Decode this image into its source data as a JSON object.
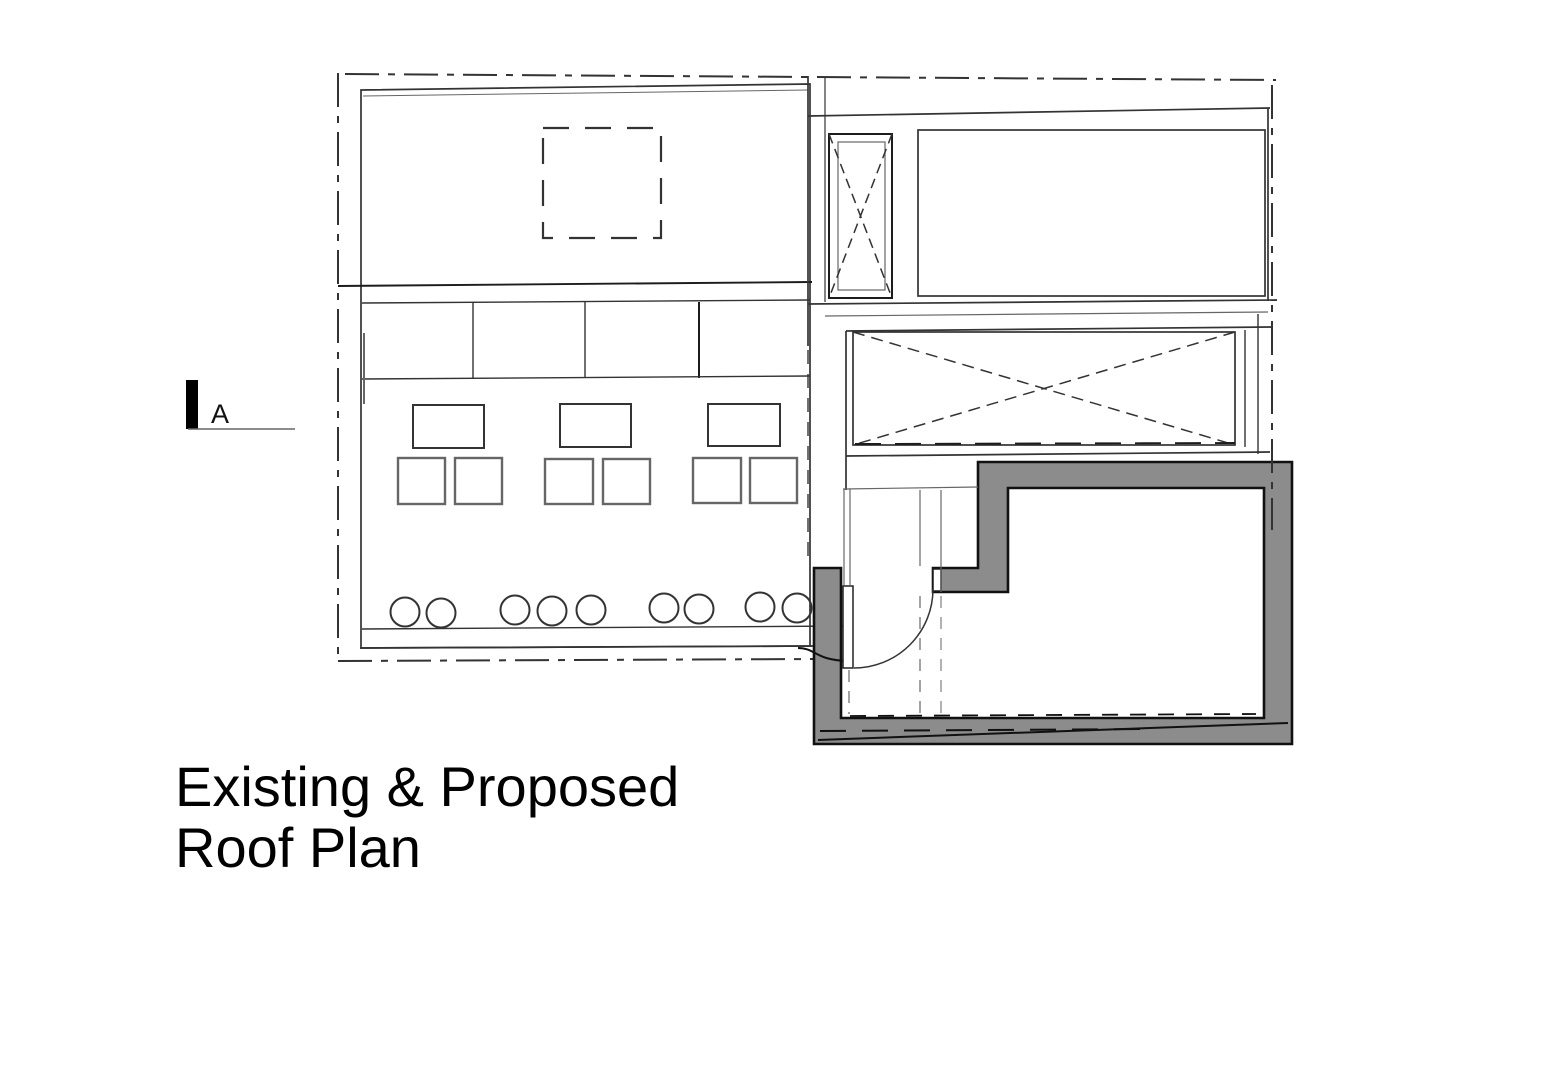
{
  "title": {
    "line1": "Existing & Proposed",
    "line2": "Roof Plan"
  },
  "section_marker": {
    "label": "A"
  },
  "colors": {
    "wall_fill": "#8c8c8c",
    "wall_outline": "#111111",
    "line_color": "#333333",
    "bg": "#ffffff"
  }
}
